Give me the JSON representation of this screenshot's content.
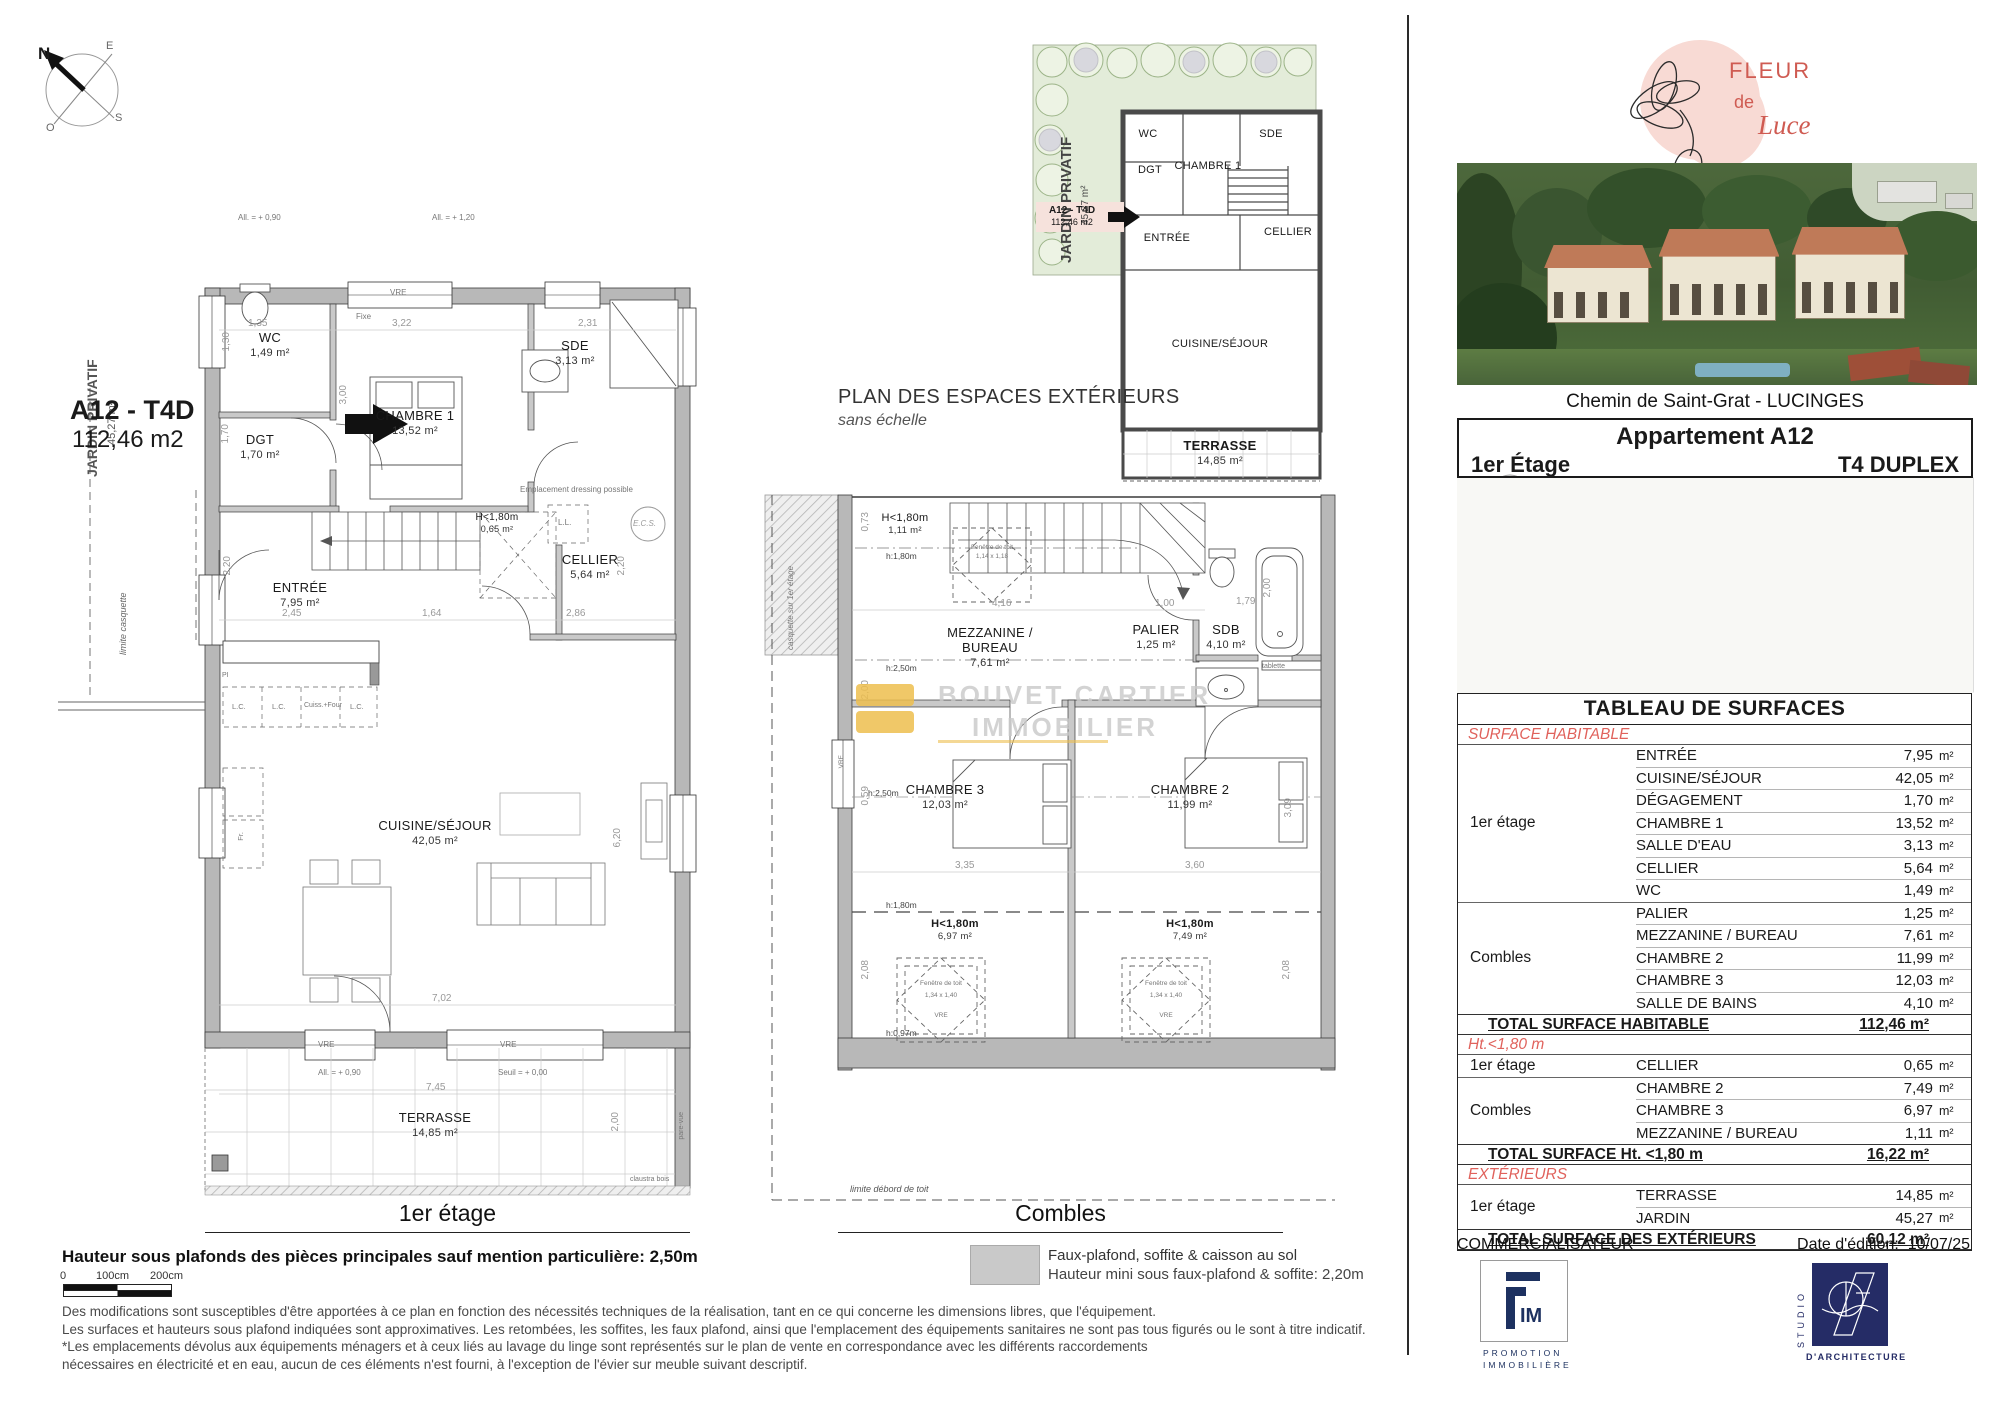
{
  "compass": {
    "n": "N",
    "e": "E",
    "s": "S",
    "o": "O"
  },
  "floor1": {
    "caption": "1er étage",
    "unit_tag_line1": "A12 - T4D",
    "unit_tag_line2": "112,46 m2",
    "jardin_label": "JARDIN PRIVATIF",
    "jardin_area": "45,27 m²",
    "limite_casquette": "limite casquette",
    "rooms": {
      "wc": {
        "name": "WC",
        "area": "1,49 m²"
      },
      "dgt": {
        "name": "DGT",
        "area": "1,70 m²"
      },
      "chambre1": {
        "name": "CHAMBRE 1",
        "area": "13,52 m²"
      },
      "sde": {
        "name": "SDE",
        "area": "3,13 m²"
      },
      "cellier": {
        "name": "CELLIER",
        "area": "5,64 m²"
      },
      "entree": {
        "name": "ENTRÉE",
        "area": "7,95 m²"
      },
      "cuisine": {
        "name": "CUISINE/SÉJOUR",
        "area": "42,05 m²"
      },
      "terrasse": {
        "name": "TERRASSE",
        "area": "14,85 m²"
      },
      "sous_pente": {
        "name": "H<1,80m",
        "area": "0,65 m²"
      }
    },
    "dims": {
      "d135": "1,35",
      "d322": "3,22",
      "d231": "2,31",
      "d300": "3,00",
      "d170": "1,70",
      "d130": "1,30",
      "d245": "2,45",
      "d164": "1,64",
      "d286": "2,86",
      "d220a": "2,20",
      "d220b": "2,20",
      "d702": "7,02",
      "d620": "6,20",
      "d745": "7,45",
      "d200": "2,00"
    },
    "annotations": {
      "fixe": "Fixe",
      "vre": "VRE",
      "lc": "L.C.",
      "cuiss": "Cuiss.+Four",
      "fr": "Fr.",
      "pi": "PI",
      "ll": "L.L.",
      "ecs": "E.C.S.",
      "dressing": "Emplacement dressing possible",
      "allege090": "All. = + 0,90",
      "allege120": "All. = + 1,20",
      "seuil": "Seuil = + 0,00",
      "claustra": "claustra bois",
      "parevue": "pare-vue"
    }
  },
  "plan_ext": {
    "title": "PLAN DES ESPACES EXTÉRIEURS",
    "subtitle": "sans échelle",
    "jardin_label": "JARDIN PRIVATIF",
    "jardin_area": "45,27 m²",
    "tag_line1": "A12 - T4D",
    "tag_line2": "112,46 m2",
    "rooms": {
      "wc": "WC",
      "dgt": "DGT",
      "chambre1": "CHAMBRE 1",
      "sde": "SDE",
      "entree": "ENTRÉE",
      "cellier": "CELLIER",
      "cuisine": "CUISINE/SÉJOUR",
      "terrasse": "TERRASSE",
      "terrasse_area": "14,85 m²"
    }
  },
  "combles": {
    "caption": "Combles",
    "casquette": "casquette sur 1er étage",
    "limite_toit": "limite débord de toit",
    "rooms": {
      "mezzanine": {
        "name": "MEZZANINE / BUREAU",
        "area": "7,61 m²"
      },
      "palier": {
        "name": "PALIER",
        "area": "1,25 m²"
      },
      "sdb": {
        "name": "SDB",
        "area": "4,10 m²"
      },
      "chambre3": {
        "name": "CHAMBRE 3",
        "area": "12,03 m²"
      },
      "chambre2": {
        "name": "CHAMBRE 2",
        "area": "11,99 m²"
      },
      "sp_top": {
        "name": "H<1,80m",
        "area": "1,11 m²"
      },
      "sp_ch3": {
        "name": "H<1,80m",
        "area": "6,97 m²"
      },
      "sp_ch2": {
        "name": "H<1,80m",
        "area": "7,49 m²"
      }
    },
    "dims": {
      "d073": "0,73",
      "d416": "4,16",
      "d100": "1,00",
      "d200a": "2,00",
      "d179": "1,79",
      "d200b": "2,00",
      "d335": "3,35",
      "d360": "3,60",
      "d208a": "2,08",
      "d208b": "2,08",
      "d309": "3,09",
      "d059": "0,59"
    },
    "annotations": {
      "h180": "h:1,80m",
      "h250": "h:2,50m",
      "h097": "h:0,97m",
      "tablette": "tablette",
      "fen_toit": "Fenêtre de toit",
      "fen_dim_top": "1,14 x 1,18",
      "fen_dim": "1,34 x 1,40",
      "vre": "VRE"
    },
    "watermark": {
      "line1": "BOUVET CARTIER",
      "line2": "IMMOBILIER"
    }
  },
  "legend": {
    "swatch_color": "#c9c9c9",
    "line1": "Faux-plafond, soffite & caisson au sol",
    "line2": "Hauteur mini sous faux-plafond & soffite: 2,20m"
  },
  "notes": {
    "bold": "Hauteur sous plafonds des pièces principales sauf mention particulière: 2,50m",
    "scale": {
      "zero": "0",
      "mid": "100cm",
      "end": "200cm"
    },
    "lines": [
      "Des modifications sont susceptibles d'être apportées à ce plan en fonction des nécessités techniques de la réalisation, tant en ce qui concerne les dimensions libres, que l'équipement.",
      "Les surfaces et hauteurs sous plafond indiquées sont approximatives. Les retombées, les soffites, les faux plafond, ainsi que l'emplacement des équipements sanitaires ne sont pas tous figurés ou le sont à titre indicatif.",
      "*Les emplacements dévolus aux équipements ménagers et à ceux liés au lavage du linge sont représentés sur le plan de vente en correspondance avec les différents raccordements",
      "nécessaires en électricité et en eau, aucun de ces éléments n'est fourni, à l'exception de l'évier sur meuble suivant descriptif."
    ]
  },
  "sidebar": {
    "brand": {
      "line1": "FLEUR",
      "line2": "de",
      "line3": "Luce",
      "accent": "#cf5b52",
      "blob": "#f8dad4"
    },
    "address": "Chemin de Saint-Grat - LUCINGES",
    "unit_box": {
      "title": "Appartement A12",
      "floor": "1er Étage",
      "type": "T4 DUPLEX"
    },
    "table": {
      "title": "TABLEAU DE SURFACES",
      "unit": "m²",
      "sections": [
        {
          "header": "SURFACE HABITABLE",
          "groups": [
            {
              "name": "1er étage",
              "rows": [
                {
                  "room": "ENTRÉE",
                  "value": "7,95"
                },
                {
                  "room": "CUISINE/SÉJOUR",
                  "value": "42,05"
                },
                {
                  "room": "DÉGAGEMENT",
                  "value": "1,70"
                },
                {
                  "room": "CHAMBRE 1",
                  "value": "13,52"
                },
                {
                  "room": "SALLE D'EAU",
                  "value": "3,13"
                },
                {
                  "room": "CELLIER",
                  "value": "5,64"
                },
                {
                  "room": "WC",
                  "value": "1,49"
                }
              ]
            },
            {
              "name": "Combles",
              "rows": [
                {
                  "room": "PALIER",
                  "value": "1,25"
                },
                {
                  "room": "MEZZANINE / BUREAU",
                  "value": "7,61"
                },
                {
                  "room": "CHAMBRE 2",
                  "value": "11,99"
                },
                {
                  "room": "CHAMBRE 3",
                  "value": "12,03"
                },
                {
                  "room": "SALLE DE BAINS",
                  "value": "4,10"
                }
              ]
            }
          ],
          "total_label": "TOTAL SURFACE HABITABLE",
          "total_value": "112,46 m²"
        },
        {
          "header": "Ht.<1,80 m",
          "groups": [
            {
              "name": "1er étage",
              "rows": [
                {
                  "room": "CELLIER",
                  "value": "0,65"
                }
              ]
            },
            {
              "name": "Combles",
              "rows": [
                {
                  "room": "CHAMBRE 2",
                  "value": "7,49"
                },
                {
                  "room": "CHAMBRE 3",
                  "value": "6,97"
                },
                {
                  "room": "MEZZANINE / BUREAU",
                  "value": "1,11"
                }
              ]
            }
          ],
          "total_label": "TOTAL SURFACE Ht. <1,80 m",
          "total_value": "16,22 m²"
        },
        {
          "header": "EXTÉRIEURS",
          "groups": [
            {
              "name": "1er étage",
              "rows": [
                {
                  "room": "TERRASSE",
                  "value": "14,85"
                },
                {
                  "room": "JARDIN",
                  "value": "45,27"
                }
              ]
            }
          ],
          "total_label": "TOTAL SURFACE DES EXTÉRIEURS",
          "total_value": "60,12 m²"
        }
      ]
    },
    "commercialisateur": "COMMERCIALISATEUR",
    "date_label": "Date d'édition:",
    "date_value": "10/07/25",
    "fim": {
      "im": "IM",
      "line1": "PROMOTION",
      "line2": "IMMOBILIÈRE"
    },
    "studio": {
      "vertical": "STUDIO",
      "bottom": "D'ARCHITECTURE"
    }
  }
}
